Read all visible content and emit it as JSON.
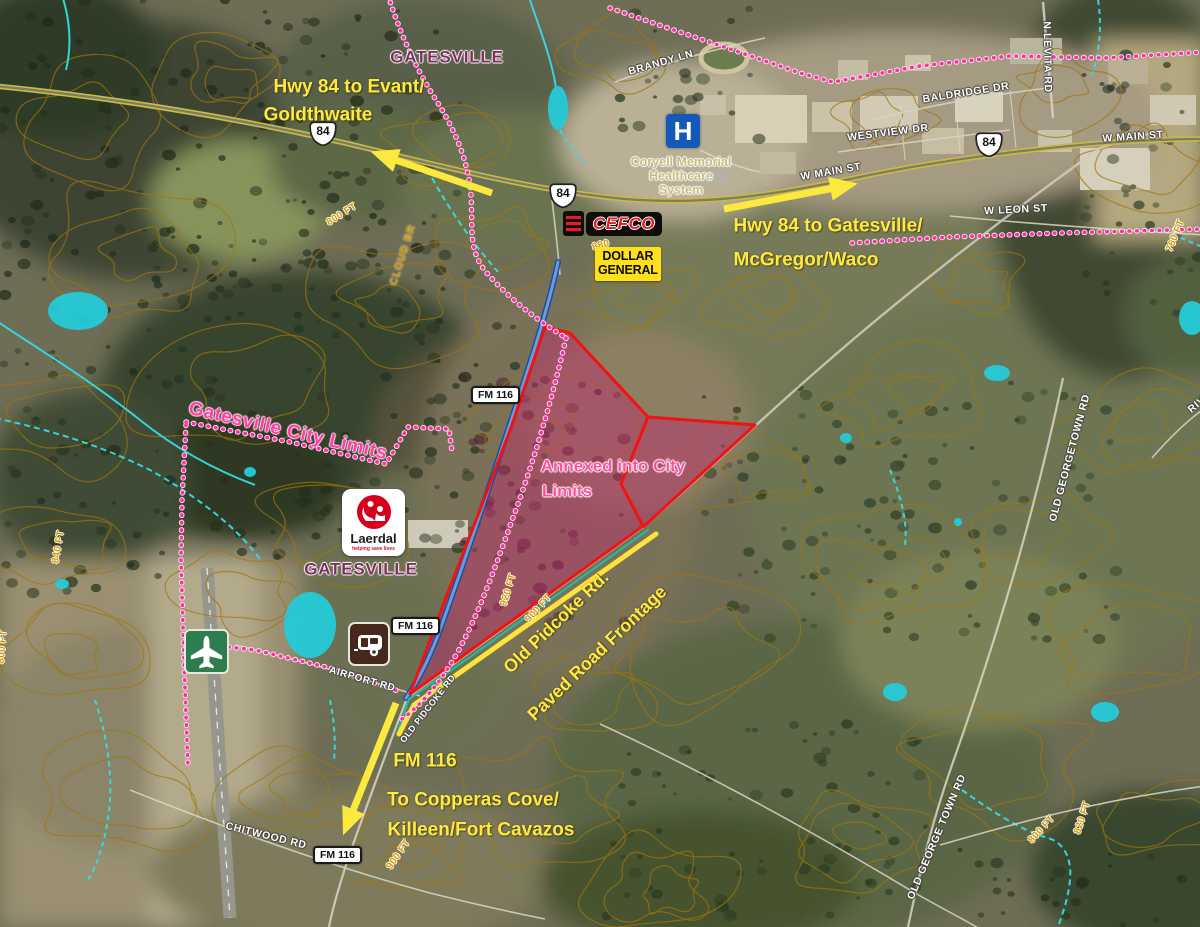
{
  "region": "Gatesville, Texas aerial annotation map",
  "annotations": {
    "hwy84_west_line1": "Hwy 84 to Evant/",
    "hwy84_west_line2": "Goldthwaite",
    "hwy84_east_line1": "Hwy 84 to Gatesville/",
    "hwy84_east_line2": "McGregor/Waco",
    "fm116_south_line1": "FM 116",
    "fm116_south_line2": "To Copperas Cove/",
    "fm116_south_line3": "Killeen/Fort Cavazos",
    "annexed_line1": "Annexed into City",
    "annexed_line2": "Limits",
    "city_limits": "Gatesville City Limits",
    "old_pidcoke_line1": "Old Pidcoke Rd.",
    "old_pidcoke_line2": "Paved Road Frontage"
  },
  "places": {
    "gatesville_north": "GATESVILLE",
    "gatesville_south": "GATESVILLE",
    "hospital_line1": "Coryell Memorial",
    "hospital_line2": "Healthcare",
    "hospital_line3": "System",
    "hospital_symbol": "H",
    "cefco": "CEFCO",
    "dollar_general_line1": "DOLLAR",
    "dollar_general_line2": "GENERAL",
    "laerdal_name": "Laerdal",
    "laerdal_tagline": "helping save lives"
  },
  "road_labels": {
    "brandy_ln": "BRANDY LN",
    "baldridge_dr": "BALDRIDGE DR",
    "n_levita_rd": "N LEVITA RD",
    "westview_dr": "WESTVIEW DR",
    "w_main_st_east": "W MAIN ST",
    "w_main_st_west": "W MAIN ST",
    "w_leon_st": "W LEON ST",
    "airport_rd": "AIRPORT RD",
    "old_pidcoke_rd": "OLD PIDCOKE RD",
    "chitwood_rd": "CHITWOOD RD",
    "old_georgetown_rd_north": "OLD GEORGETOWN RD",
    "old_georgetown_rd_south": "OLD GEORGE TOWN RD",
    "cloud_br": "CLOUD BR",
    "riv_partial": "RIV"
  },
  "shields": {
    "us84": "84",
    "fm116": "FM 116"
  },
  "contour_labels": {
    "nw_800": "800 FT",
    "cefco_880": "880",
    "parcel_920": "920 FT",
    "road_900": "900 FT",
    "sw_900": "900 FT",
    "west_840": "840 FT",
    "ne_760": "760 FT",
    "se_800": "800 FT",
    "se_820": "820 FT",
    "left_800": "800 FT"
  },
  "colors": {
    "annotation_yellow": "#FFE93E",
    "city_limits_pink": "#FF3DAE",
    "annexed_fill": "#C02A6C",
    "annexed_outline": "#EE1212",
    "contour_gold": "#A0760E",
    "water_cyan": "#35DCE6",
    "fm116_highlight_blue": "#4A78C8",
    "frontage_highlight_yellow": "#FFE33C"
  }
}
